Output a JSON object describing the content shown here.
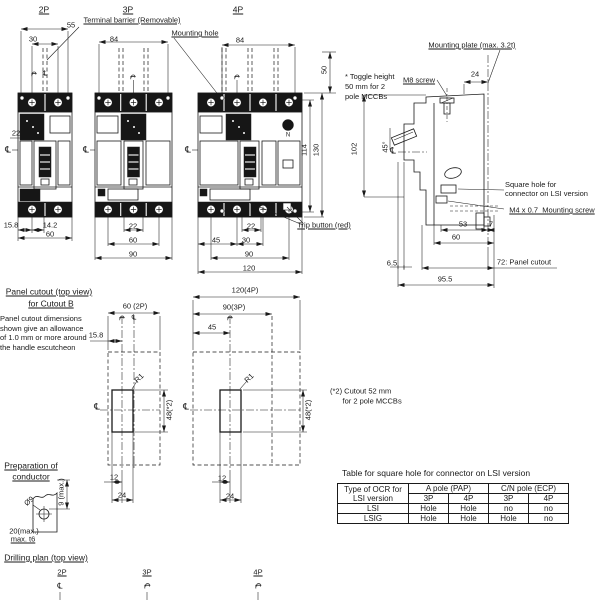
{
  "colors": {
    "ink": "#1a1a1a",
    "background": "#ffffff"
  },
  "table": {
    "title": "Table for square hole for connector on LSI version",
    "col1": [
      "Type of OCR for",
      "LSI version"
    ],
    "groups": [
      "A pole (PAP)",
      "C/N pole (ECP)"
    ],
    "subs": [
      "3P",
      "4P",
      "3P",
      "4P"
    ],
    "rows": [
      {
        "name": "LSI",
        "values": [
          "Hole",
          "Hole",
          "no",
          "no"
        ]
      },
      {
        "name": "LSIG",
        "values": [
          "Hole",
          "Hole",
          "Hole",
          "no"
        ]
      }
    ]
  },
  "labels": [
    {
      "n": "view-label-2p",
      "t": "2P",
      "x": 44,
      "y": 10,
      "u": 1,
      "fs": 8.5
    },
    {
      "n": "view-label-3p",
      "t": "3P",
      "x": 128,
      "y": 10,
      "u": 1,
      "fs": 8.5
    },
    {
      "n": "view-label-4p",
      "t": "4P",
      "x": 238,
      "y": 10,
      "u": 1,
      "fs": 8.5
    },
    {
      "n": "terminal-barrier-label",
      "t": "Terminal barrier (Removable)",
      "x": 132,
      "y": 20,
      "u": 1
    },
    {
      "n": "mounting-hole-label",
      "t": "Mounting hole",
      "x": 195,
      "y": 33,
      "u": 1
    },
    {
      "n": "dim-55",
      "t": "55",
      "x": 71,
      "y": 25
    },
    {
      "n": "dim-30-2p",
      "t": "30",
      "x": 33,
      "y": 39
    },
    {
      "n": "dim-84-3p",
      "t": "84",
      "x": 114,
      "y": 39
    },
    {
      "n": "dim-84-4p",
      "t": "84",
      "x": 240,
      "y": 40
    },
    {
      "n": "dim-50-toggle",
      "t": "50",
      "x": 324,
      "y": 70,
      "r": -90
    },
    {
      "n": "toggle-height-note",
      "t": "* Toggle height\n50 mm for 2\npole MCCBs",
      "x": 374,
      "y": 87,
      "ta": "l",
      "w": 58,
      "lh": 10
    },
    {
      "n": "mounting-plate-label",
      "t": "Mounting plate (max. 3.2t)",
      "x": 472,
      "y": 45,
      "u": 1
    },
    {
      "n": "m8-screw-label",
      "t": "M8 screw",
      "x": 419,
      "y": 80,
      "u": 1
    },
    {
      "n": "dim-24-side",
      "t": "24",
      "x": 475,
      "y": 74
    },
    {
      "n": "dim-22-2p",
      "t": "22",
      "x": 16,
      "y": 133
    },
    {
      "n": "cl-2p",
      "t": "℄",
      "x": 8,
      "y": 150,
      "fs": 9
    },
    {
      "n": "cl-3p",
      "t": "℄",
      "x": 86,
      "y": 150,
      "fs": 9
    },
    {
      "n": "cl-4p",
      "t": "℄",
      "x": 188,
      "y": 150,
      "fs": 9
    },
    {
      "n": "cl-side",
      "t": "℄",
      "x": 393,
      "y": 151,
      "fs": 9
    },
    {
      "n": "cl-mark-2p-a",
      "t": "℄",
      "x": 33,
      "y": 74,
      "r": 90,
      "fs": 7
    },
    {
      "n": "cl-mark-2p-b",
      "t": "℄",
      "x": 45,
      "y": 74,
      "fs": 7
    },
    {
      "n": "cl-mark-3p",
      "t": "℄",
      "x": 132,
      "y": 77,
      "r": 90,
      "fs": 7
    },
    {
      "n": "cl-mark-4p",
      "t": "℄",
      "x": 236,
      "y": 77,
      "r": 90,
      "fs": 7
    },
    {
      "n": "dim-102",
      "t": "102",
      "x": 354,
      "y": 149,
      "r": -90
    },
    {
      "n": "dim-45-deg",
      "t": "45°",
      "x": 385,
      "y": 147,
      "r": -90
    },
    {
      "n": "dim-114",
      "t": "114",
      "x": 304,
      "y": 150,
      "r": -90
    },
    {
      "n": "dim-130",
      "t": "130",
      "x": 316,
      "y": 150,
      "r": -90
    },
    {
      "n": "square-hole-label",
      "t": "Square hole for\nconnector on LSI version",
      "x": 551,
      "y": 189,
      "ta": "l",
      "w": 92
    },
    {
      "n": "m4-screw-label",
      "t": "M4 x 0.7  Mounting screw",
      "x": 552,
      "y": 210,
      "u": 1
    },
    {
      "n": "dim-53",
      "t": "53",
      "x": 463,
      "y": 224
    },
    {
      "n": "dim-7",
      "t": "7",
      "x": 491,
      "y": 224
    },
    {
      "n": "dim-60-side",
      "t": "60",
      "x": 456,
      "y": 237
    },
    {
      "n": "dim-6-5",
      "t": "6.5",
      "x": 392,
      "y": 263
    },
    {
      "n": "panel-cutout-72-label",
      "t": "72: Panel cutout",
      "x": 524,
      "y": 262
    },
    {
      "n": "dim-95-5",
      "t": "95.5",
      "x": 445,
      "y": 279
    },
    {
      "n": "dim-15-8-2p",
      "t": "15.8",
      "x": 11,
      "y": 225
    },
    {
      "n": "dim-14-2",
      "t": "14.2",
      "x": 50,
      "y": 225
    },
    {
      "n": "dim-60-2p-bottom",
      "t": "60",
      "x": 50,
      "y": 234
    },
    {
      "n": "dim-22-3p",
      "t": "22",
      "x": 133,
      "y": 226
    },
    {
      "n": "dim-60-3p",
      "t": "60",
      "x": 133,
      "y": 240
    },
    {
      "n": "dim-90-3p-bottom",
      "t": "90",
      "x": 133,
      "y": 254
    },
    {
      "n": "dim-22-4p",
      "t": "22",
      "x": 251,
      "y": 226
    },
    {
      "n": "dim-45-4p",
      "t": "45",
      "x": 216,
      "y": 240
    },
    {
      "n": "dim-30-4p",
      "t": "30",
      "x": 246,
      "y": 240
    },
    {
      "n": "dim-90-4p",
      "t": "90",
      "x": 249,
      "y": 254
    },
    {
      "n": "dim-120-4p-bottom",
      "t": "120",
      "x": 249,
      "y": 268
    },
    {
      "n": "trip-button-label",
      "t": "Trip button (red)",
      "x": 324,
      "y": 225,
      "u": 1
    },
    {
      "n": "pole-n-marking",
      "t": "N",
      "x": 288,
      "y": 136,
      "fs": 6
    },
    {
      "n": "pc-title-line1",
      "t": "Panel cutout (top view)",
      "x": 49,
      "y": 292,
      "u": 1,
      "fs": 8.5
    },
    {
      "n": "pc-title-line2",
      "t": "for Cutout B",
      "x": 51,
      "y": 304,
      "u": 1,
      "fs": 8.5
    },
    {
      "n": "pc-note",
      "t": "Panel cutout dimensions\nshown give an allowance\nof 1.0 mm or more around\nthe handle escutcheon",
      "x": 47,
      "y": 333,
      "ta": "l",
      "w": 94,
      "lh": 9.5
    },
    {
      "n": "dim-15-8-pc",
      "t": "15.8",
      "x": 96,
      "y": 335
    },
    {
      "n": "dim-60-2p-pc",
      "t": "60 (2P)",
      "x": 135,
      "y": 306
    },
    {
      "n": "dim-120-4p-pc",
      "t": "120(4P)",
      "x": 245,
      "y": 290
    },
    {
      "n": "dim-90-3p-pc",
      "t": "90(3P)",
      "x": 234,
      "y": 307
    },
    {
      "n": "dim-45-pc",
      "t": "45",
      "x": 212,
      "y": 327
    },
    {
      "n": "r1-left",
      "t": "R1",
      "x": 139,
      "y": 378,
      "r": -45
    },
    {
      "n": "r1-right",
      "t": "R1",
      "x": 249,
      "y": 378,
      "r": -45
    },
    {
      "n": "dim-48-left",
      "t": "48(*2)",
      "x": 169,
      "y": 410,
      "r": -90
    },
    {
      "n": "dim-48-right",
      "t": "48(*2)",
      "x": 308,
      "y": 410,
      "r": -90
    },
    {
      "n": "cl-mark-pc-a",
      "t": "℄",
      "x": 121,
      "y": 318,
      "r": 90,
      "fs": 7
    },
    {
      "n": "cl-mark-pc-b",
      "t": "℄",
      "x": 134,
      "y": 318,
      "fs": 7
    },
    {
      "n": "cl-mark-pc-c",
      "t": "℄",
      "x": 229,
      "y": 318,
      "r": 90,
      "fs": 7
    },
    {
      "n": "cl-pc-left",
      "t": "℄",
      "x": 97,
      "y": 407,
      "fs": 9
    },
    {
      "n": "cl-pc-right",
      "t": "℄",
      "x": 186,
      "y": 407,
      "fs": 9
    },
    {
      "n": "cutout-52-note",
      "t": "(*2) Cutout 52 mm\n      for 2 pole MCCBs",
      "x": 363,
      "y": 396,
      "ta": "l",
      "w": 66,
      "lh": 9.5
    },
    {
      "n": "dim-12-left",
      "t": "12",
      "x": 114,
      "y": 477
    },
    {
      "n": "dim-24-left",
      "t": "24",
      "x": 122,
      "y": 495
    },
    {
      "n": "dim-12-right",
      "t": "12",
      "x": 222,
      "y": 478
    },
    {
      "n": "dim-24-right",
      "t": "24",
      "x": 230,
      "y": 496
    },
    {
      "n": "prep-title-line1",
      "t": "Preparation of",
      "x": 31,
      "y": 466,
      "u": 1,
      "fs": 8.5
    },
    {
      "n": "prep-title-line2",
      "t": "conductor",
      "x": 31,
      "y": 477,
      "u": 1,
      "fs": 8.5
    },
    {
      "n": "dia-9",
      "t": "Ø9",
      "x": 29,
      "y": 501,
      "r": -40
    },
    {
      "n": "dim-9-max",
      "t": "9 (max.)",
      "x": 61,
      "y": 492,
      "r": -90
    },
    {
      "n": "note-20-max",
      "t": "20(max.)",
      "x": 24,
      "y": 531
    },
    {
      "n": "note-max-t6",
      "t": "max. t6",
      "x": 23,
      "y": 539,
      "u": 1
    },
    {
      "n": "drill-title",
      "t": "Drilling plan (top view)",
      "x": 46,
      "y": 558,
      "u": 1,
      "fs": 8.5
    },
    {
      "n": "drill-2p",
      "t": "2P",
      "x": 62,
      "y": 572,
      "u": 1
    },
    {
      "n": "drill-3p",
      "t": "3P",
      "x": 147,
      "y": 572,
      "u": 1
    },
    {
      "n": "drill-4p",
      "t": "4P",
      "x": 258,
      "y": 572,
      "u": 1
    },
    {
      "n": "cl-drill-2p",
      "t": "℄",
      "x": 60,
      "y": 586,
      "fs": 8
    },
    {
      "n": "cl-drill-3p",
      "t": "℄",
      "x": 147,
      "y": 586,
      "r": 90,
      "fs": 8
    },
    {
      "n": "cl-drill-4p",
      "t": "℄",
      "x": 258,
      "y": 586,
      "r": 90,
      "fs": 8
    }
  ]
}
